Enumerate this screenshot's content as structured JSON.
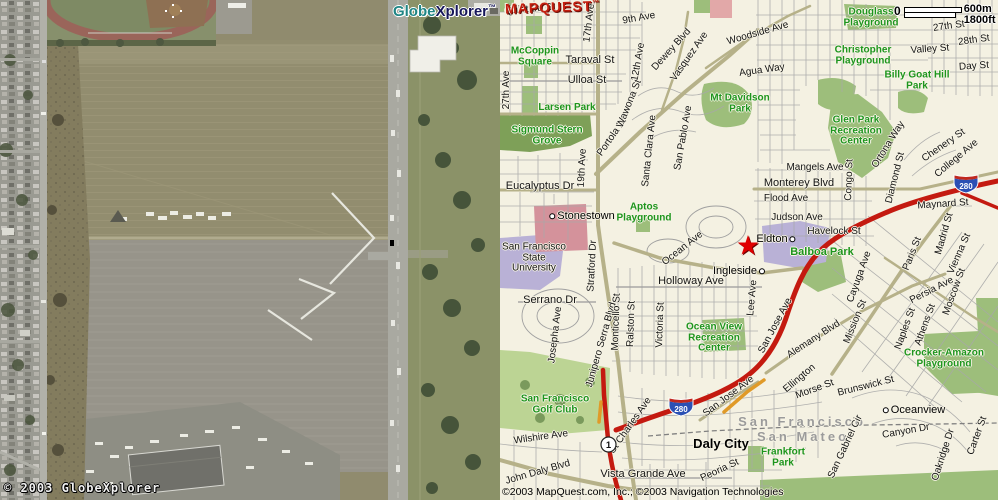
{
  "satellite": {
    "logo": {
      "globe": "Globe",
      "xplorer": "Xplorer",
      "tm": "™"
    },
    "copyright": "© 2003 GlobeXplorer"
  },
  "map": {
    "logo": {
      "text": "MAPQUEST",
      "tm": "™"
    },
    "scale": {
      "zero": "0",
      "metric": "600m",
      "imperial": "1800ft"
    },
    "copyright": "©2003 MapQuest.com, Inc.; ©2003 Navigation Technologies",
    "shield_280": "280",
    "shield_1": "1",
    "icons": {
      "star_marker": "★"
    },
    "colors": {
      "freeway_red": "#c41a10",
      "arterial_olive": "#b6b189",
      "park_green": "#9dbe7b",
      "label_green": "#1d951d",
      "logo_red": "#c42010",
      "globe_teal": "#1f8585",
      "xplorer_navy": "#16165a"
    },
    "labels": [
      {
        "t": "Quintara St",
        "x": 30,
        "y": 10,
        "r": -5
      },
      {
        "t": "27th Ave",
        "x": 7,
        "y": 90,
        "r": -90
      },
      {
        "t": "Taraval St",
        "x": 90,
        "y": 61,
        "c": "st2"
      },
      {
        "t": "Ulloa St",
        "x": 87,
        "y": 81,
        "c": "st2"
      },
      {
        "t": "17th Ave",
        "x": 90,
        "y": 23,
        "r": -83
      },
      {
        "t": "9th Ave",
        "x": 139,
        "y": 19,
        "r": -10
      },
      {
        "t": "12th Ave",
        "x": 139,
        "y": 62,
        "r": -80
      },
      {
        "t": "Dewey Blvd",
        "x": 172,
        "y": 50,
        "r": -48
      },
      {
        "t": "Vasquez Ave",
        "x": 190,
        "y": 57,
        "r": -55
      },
      {
        "t": "Woodside Ave",
        "x": 258,
        "y": 34,
        "r": -16
      },
      {
        "t": "Agua Way",
        "x": 262,
        "y": 71,
        "r": -8
      },
      {
        "t": "McCoppin\nSquare",
        "x": 35,
        "y": 57,
        "c": "pk"
      },
      {
        "t": "Larsen Park",
        "x": 67,
        "y": 108,
        "c": "pk"
      },
      {
        "t": "Sigmund Stern\nGrove",
        "x": 47,
        "y": 136,
        "c": "pk"
      },
      {
        "t": "Eucalyptus Dr",
        "x": 40,
        "y": 187,
        "c": "st2"
      },
      {
        "t": "19th Ave",
        "x": 83,
        "y": 168,
        "r": -87
      },
      {
        "t": "Portola Dr",
        "x": 113,
        "y": 137,
        "r": -55
      },
      {
        "t": "Wawona St",
        "x": 130,
        "y": 104,
        "r": -68
      },
      {
        "t": "Santa Clara Ave",
        "x": 150,
        "y": 151,
        "r": -84
      },
      {
        "t": "San Pablo Ave",
        "x": 184,
        "y": 138,
        "r": -80
      },
      {
        "t": "Stonestown",
        "x": 81,
        "y": 217,
        "c": "nbhd",
        "dot": "l"
      },
      {
        "t": "Aptos\nPlayground",
        "x": 144,
        "y": 213,
        "c": "pk"
      },
      {
        "t": "Mt Davidson\nPark",
        "x": 240,
        "y": 104,
        "c": "pk"
      },
      {
        "t": "Glen Park\nRecreation\nCenter",
        "x": 356,
        "y": 131,
        "c": "pk"
      },
      {
        "t": "Mangels Ave",
        "x": 315,
        "y": 168
      },
      {
        "t": "Monterey Blvd",
        "x": 299,
        "y": 184,
        "c": "st2"
      },
      {
        "t": "Flood Ave",
        "x": 286,
        "y": 199
      },
      {
        "t": "Judson Ave",
        "x": 297,
        "y": 218
      },
      {
        "t": "Havelock St",
        "x": 334,
        "y": 232
      },
      {
        "t": "Congo St",
        "x": 350,
        "y": 180,
        "r": -88
      },
      {
        "t": "Ortona Way",
        "x": 389,
        "y": 145,
        "r": -58
      },
      {
        "t": "Diamond St",
        "x": 396,
        "y": 178,
        "r": -76
      },
      {
        "t": "Chenery St",
        "x": 444,
        "y": 146,
        "r": -35
      },
      {
        "t": "College Ave",
        "x": 457,
        "y": 159,
        "r": -40
      },
      {
        "t": "Maynard St",
        "x": 443,
        "y": 205,
        "r": -4
      },
      {
        "t": "Madrid St",
        "x": 445,
        "y": 234,
        "r": -74
      },
      {
        "t": "Balboa Park",
        "x": 322,
        "y": 253,
        "c": "pk2"
      },
      {
        "t": "Eldton",
        "x": 277,
        "y": 240,
        "c": "nbhd",
        "dot": "r"
      },
      {
        "t": "Ingleside",
        "x": 240,
        "y": 272,
        "c": "nbhd",
        "dot": "r"
      },
      {
        "t": "Ocean Ave",
        "x": 183,
        "y": 249,
        "r": -38
      },
      {
        "t": "Holloway Ave",
        "x": 191,
        "y": 282,
        "c": "st2"
      },
      {
        "t": "Lee Ave",
        "x": 253,
        "y": 298,
        "r": -85
      },
      {
        "t": "Ocean View\nRecreation\nCenter",
        "x": 214,
        "y": 338,
        "c": "pk"
      },
      {
        "t": "San Francisco\nState\nUniversity",
        "x": 34,
        "y": 258
      },
      {
        "t": "Serrano Dr",
        "x": 50,
        "y": 301,
        "c": "st2"
      },
      {
        "t": "Josepha Ave",
        "x": 56,
        "y": 335,
        "r": -83
      },
      {
        "t": "Stratford Dr",
        "x": 93,
        "y": 266,
        "r": -87
      },
      {
        "t": "Junipero Serra Blvd",
        "x": 102,
        "y": 345,
        "r": -74
      },
      {
        "t": "Monticello St",
        "x": 117,
        "y": 322,
        "r": -88
      },
      {
        "t": "Ralston St",
        "x": 132,
        "y": 324,
        "r": -88
      },
      {
        "t": "Victoria St",
        "x": 161,
        "y": 325,
        "r": -88
      },
      {
        "t": "San Jose Ave",
        "x": 276,
        "y": 326,
        "r": -62
      },
      {
        "t": "Alemany Blvd",
        "x": 314,
        "y": 340,
        "r": -33
      },
      {
        "t": "Mission St",
        "x": 356,
        "y": 322,
        "r": -68
      },
      {
        "t": "Cayuga Ave",
        "x": 360,
        "y": 277,
        "r": -70
      },
      {
        "t": "Paris St",
        "x": 413,
        "y": 254,
        "r": -68
      },
      {
        "t": "Persia Ave",
        "x": 432,
        "y": 291,
        "r": -27
      },
      {
        "t": "Naples St",
        "x": 406,
        "y": 329,
        "r": -70
      },
      {
        "t": "Athens St",
        "x": 426,
        "y": 325,
        "r": -70
      },
      {
        "t": "Moscow St",
        "x": 455,
        "y": 292,
        "r": -70
      },
      {
        "t": "Vienna St",
        "x": 460,
        "y": 254,
        "r": -66
      },
      {
        "t": "Crocker-Amazon\nPlayground",
        "x": 444,
        "y": 359,
        "c": "pk"
      },
      {
        "t": "Brunswick St",
        "x": 366,
        "y": 387,
        "r": -14
      },
      {
        "t": "Morse St",
        "x": 315,
        "y": 390,
        "r": -20
      },
      {
        "t": "Ellington",
        "x": 300,
        "y": 379,
        "r": -40
      },
      {
        "t": "Oceanview",
        "x": 413,
        "y": 411,
        "c": "nbhd",
        "dot": "l"
      },
      {
        "t": "San Francisco",
        "x": 302,
        "y": 422,
        "c": "county"
      },
      {
        "t": "San Mateo",
        "x": 303,
        "y": 437,
        "c": "county"
      },
      {
        "t": "Frankfort\nPark",
        "x": 283,
        "y": 458,
        "c": "pk"
      },
      {
        "t": "San Gabriel Cir",
        "x": 346,
        "y": 447,
        "r": -65
      },
      {
        "t": "Canyon Dr",
        "x": 406,
        "y": 432,
        "r": -10
      },
      {
        "t": "Oakridge Dr",
        "x": 444,
        "y": 455,
        "r": -72
      },
      {
        "t": "Carter St",
        "x": 478,
        "y": 436,
        "r": -70
      },
      {
        "t": "Daly City",
        "x": 221,
        "y": 444,
        "c": "city"
      },
      {
        "t": "Vista Grande Ave",
        "x": 143,
        "y": 475,
        "c": "st2"
      },
      {
        "t": "John Daly Blvd",
        "x": 38,
        "y": 473,
        "r": -16
      },
      {
        "t": "Wilshire Ave",
        "x": 41,
        "y": 438,
        "r": -8
      },
      {
        "t": "St Charles Ave",
        "x": 131,
        "y": 426,
        "r": -55
      },
      {
        "t": "San Jose Ave",
        "x": 229,
        "y": 397,
        "r": -37
      },
      {
        "t": "Peoria St",
        "x": 220,
        "y": 471,
        "r": -25
      },
      {
        "t": "San Francisco\nGolf Club",
        "x": 55,
        "y": 405,
        "c": "pk"
      },
      {
        "t": "Valley St",
        "x": 430,
        "y": 50,
        "r": -4
      },
      {
        "t": "27th St",
        "x": 449,
        "y": 27,
        "r": -8
      },
      {
        "t": "28th St",
        "x": 474,
        "y": 41,
        "r": -8
      },
      {
        "t": "Day St",
        "x": 474,
        "y": 67,
        "r": -4
      },
      {
        "t": "Douglass\nPlayground",
        "x": 371,
        "y": 18,
        "c": "pk"
      },
      {
        "t": "Christopher\nPlayground",
        "x": 363,
        "y": 56,
        "c": "pk"
      },
      {
        "t": "Billy Goat Hill\nPark",
        "x": 417,
        "y": 81,
        "c": "pk"
      }
    ]
  }
}
